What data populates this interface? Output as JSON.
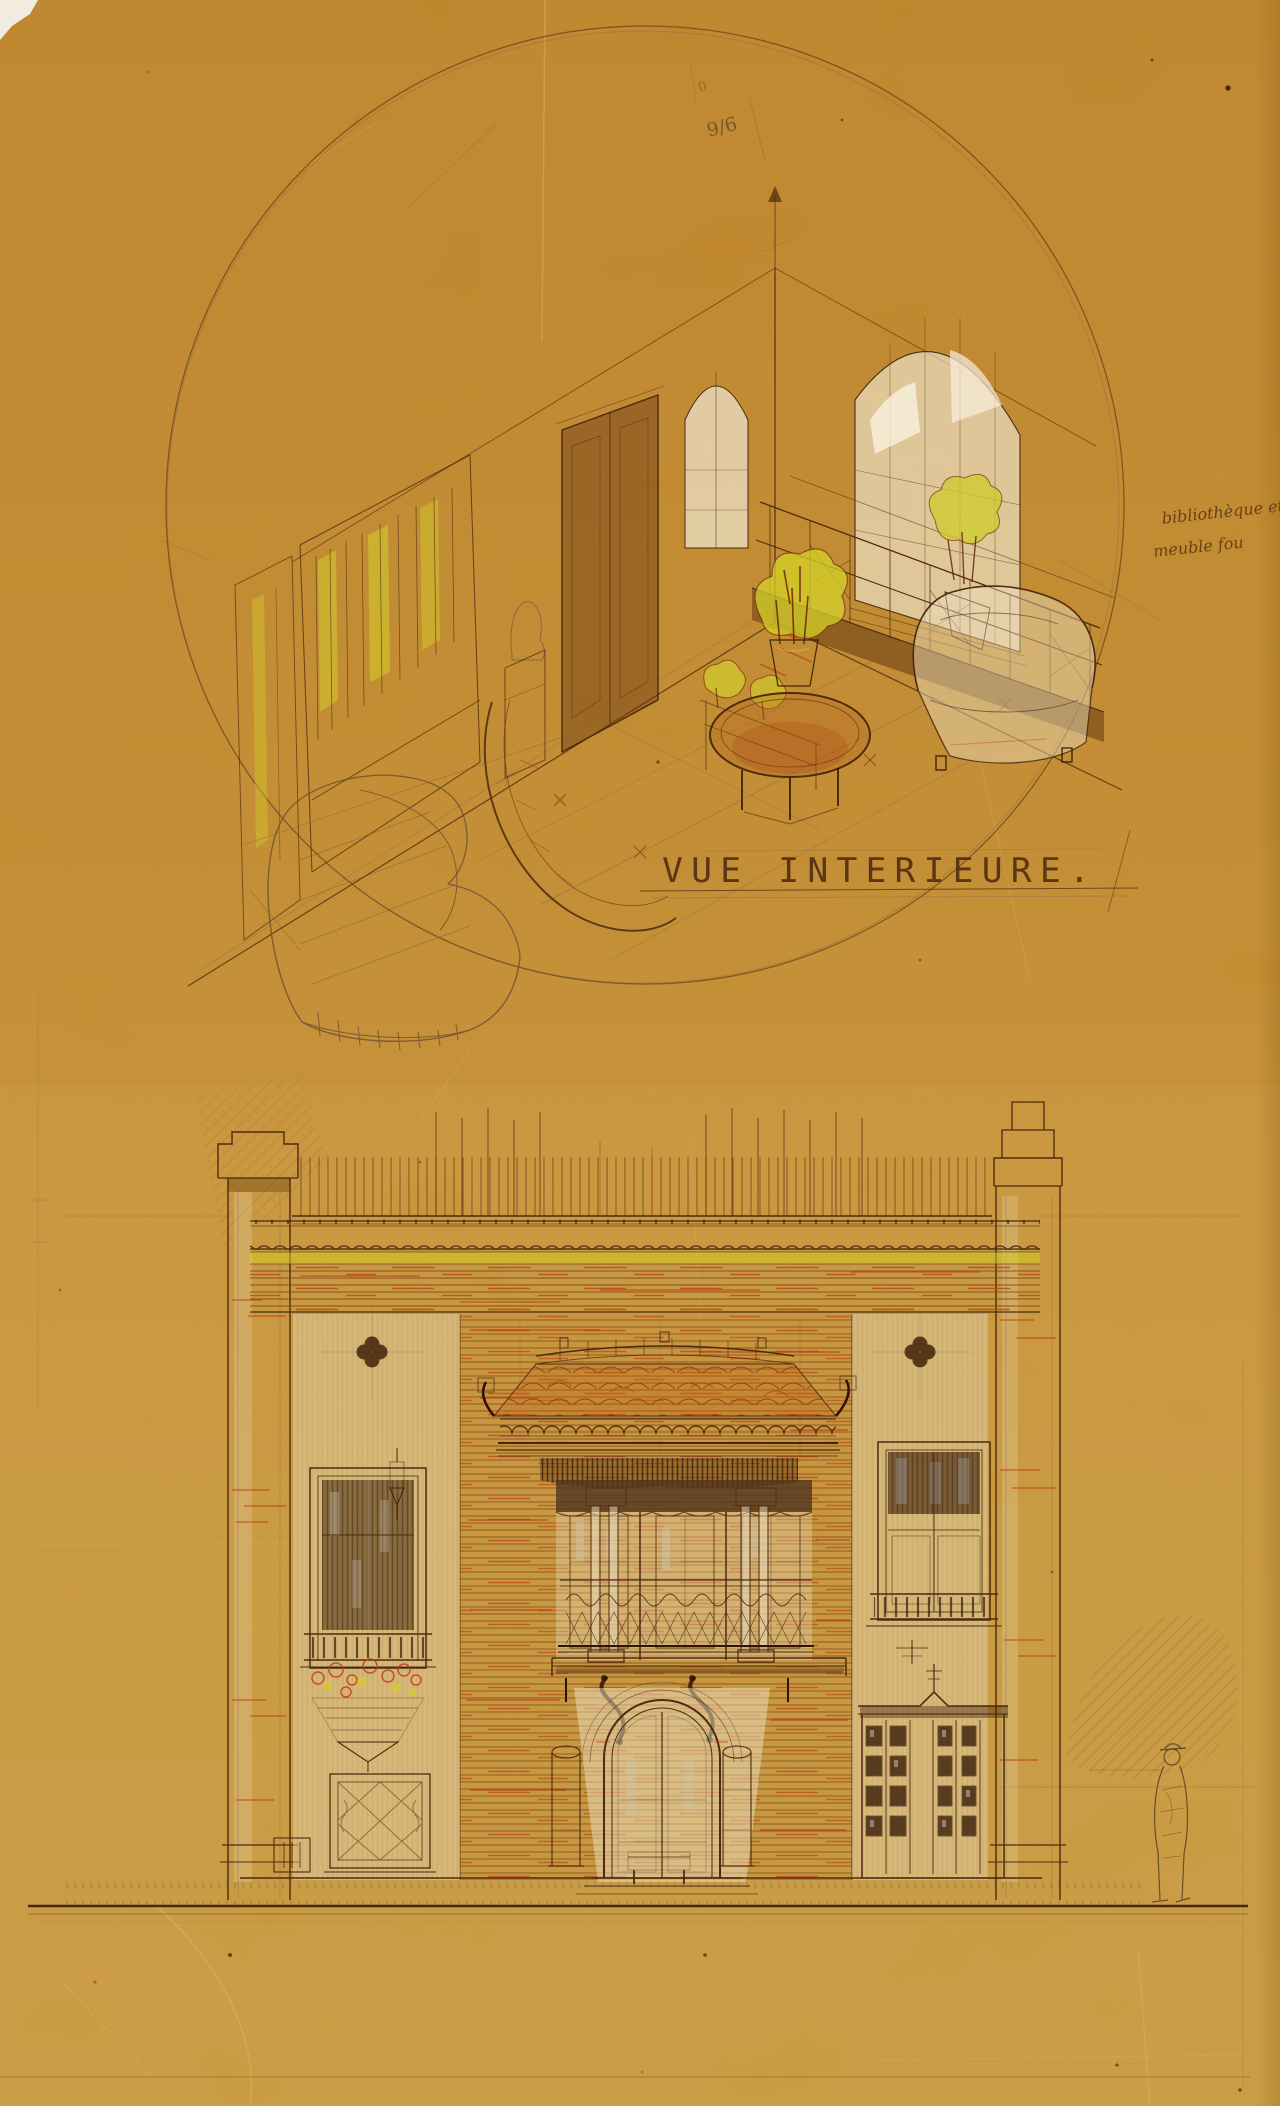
{
  "document": {
    "kind": "architectural-presentation-drawing",
    "sheets": "interior perspective above, street facade elevation below"
  },
  "interior_view": {
    "caption": "VUE INTERIEURE.",
    "fraction_note": "9/6",
    "fraction_small_mark": "0",
    "margin_note_line1": "bibliothèque et",
    "margin_note_line2": "meuble fou"
  },
  "colors": {
    "paper": "#d59932",
    "paper-top": "#cd8d27",
    "paper-low": "#d9a53e",
    "ink": "#4d2a10",
    "ink-dark": "#2f1404",
    "red": "#bf3a12",
    "yellow": "#d4cf2a",
    "cream": "#ecdfc0",
    "pencil": "#7b6347",
    "crease": "#eed27e",
    "tile-orange": "#c8621c"
  }
}
